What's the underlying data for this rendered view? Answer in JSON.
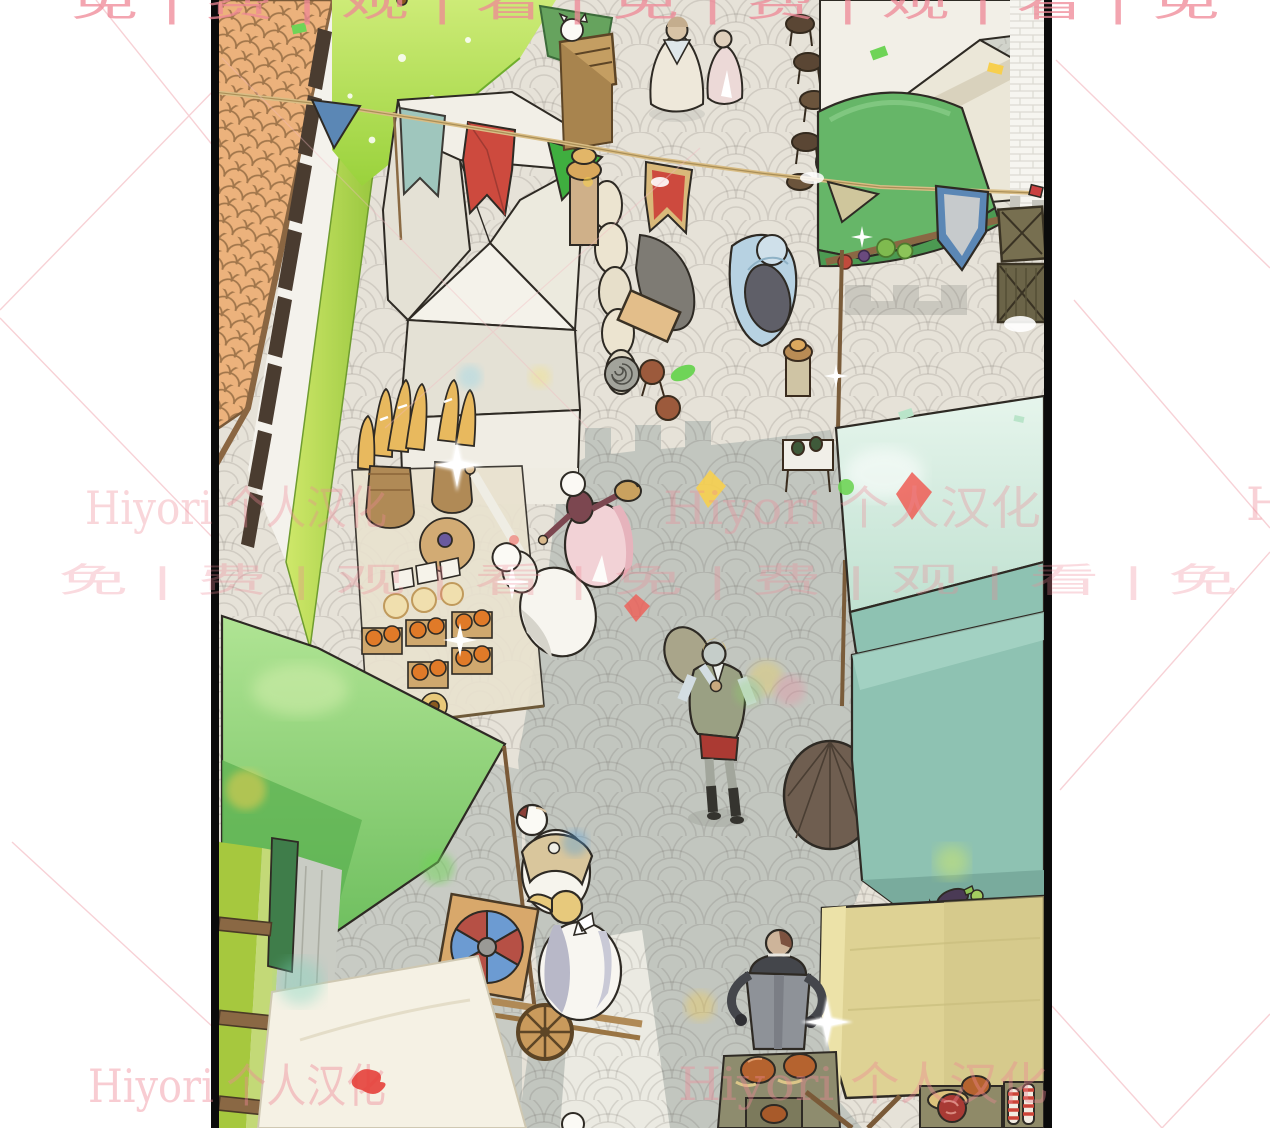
{
  "watermarks": {
    "brand_text": "Hiyori 个人汉化",
    "brand_partial": "Hi",
    "free_row_text": "免 | 费 | 观 | 看 | 免 | 费 | 观 | 看 | 免"
  },
  "colors": {
    "paper": "#ffffff",
    "border": "#0b0b0b",
    "outline": "#2e2a24",
    "street": "#e6e2d8",
    "street-shade": "#c2c6bf",
    "street-shade2": "#cdd0c9",
    "roof": "#ecb27c",
    "roof-line": "#9c734a",
    "lime": "#a8cf45",
    "grass": "#9fd23f",
    "awning-green": "#8fd57f",
    "awning-green-dark": "#63b758",
    "green-right": "#66b668",
    "tent": "#f2efe7",
    "tent-shade": "#e4e1d5",
    "mint-light": "#cde9da",
    "mint": "#8ec2b2",
    "mint-dark": "#79ab9d",
    "khaki": "#ded294",
    "wood": "#8a6844",
    "wood-light": "#caa36a",
    "crate": "#6e6847",
    "flag-red": "#cd4a3e",
    "flag-green": "#3fae3f",
    "flag-teal": "#9fc6bd",
    "flag-blue": "#5b87b5",
    "rope": "#d9bd85",
    "wm-pink": "#ef8896",
    "wm-red": "#e5403a",
    "confetti-green": "#6fd457",
    "confetti-yellow": "#f7cf4e",
    "confetti-red": "#ef5d55",
    "confetti-blue": "#5aa0d8"
  }
}
